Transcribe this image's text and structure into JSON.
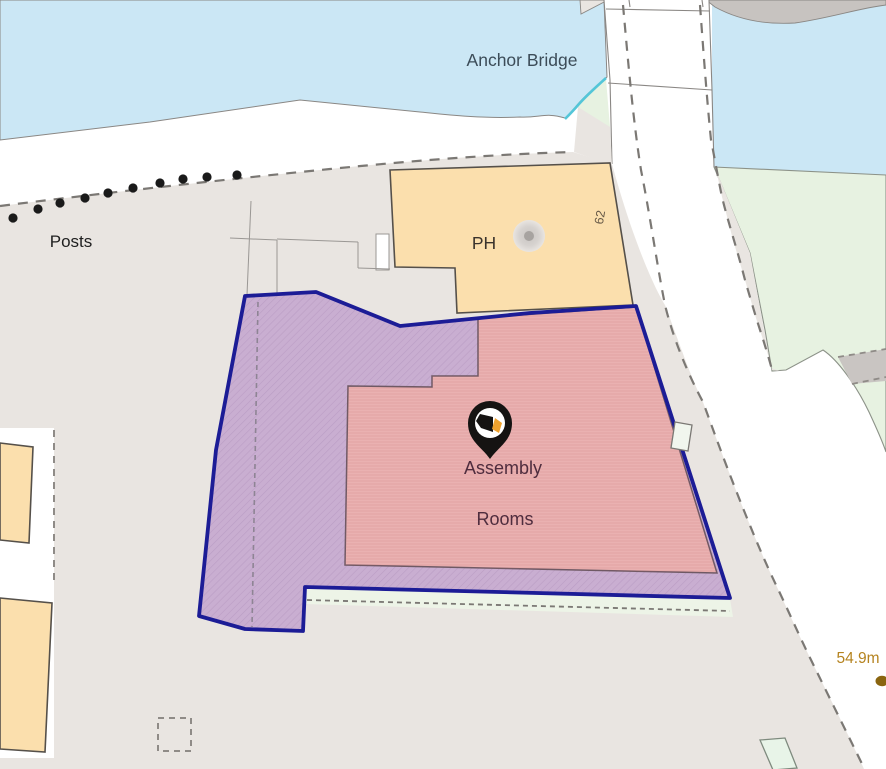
{
  "map": {
    "labels": {
      "bridge": "Anchor Bridge",
      "posts": "Posts",
      "public_house": "PH",
      "building_number": "62",
      "property_name_line1": "Assembly",
      "property_name_line2": "Rooms",
      "spot_height": "54.9m"
    },
    "colors": {
      "water": "#cbe7f5",
      "land": "#e9e5e1",
      "greenspace": "#e7f2e1",
      "greenspace_strip": "#edf4e7",
      "building_tan": "#fbdfad",
      "building_tan_outline": "#55504a",
      "building_pink": "#eab1b1",
      "building_pink_outline": "#6f5964",
      "curtilage_purple": "#c9aed1",
      "boundary_blue": "#1c1c96",
      "stream_cyan": "#54c6d8",
      "dark_gray": "#c7c3c0",
      "bridge_text": "#3c4c58",
      "posts_text": "#1f1f1f",
      "ph_text": "#3a332c",
      "property_text": "#4f2d3e",
      "spot_height_text": "#b5831f",
      "house_number_text": "#655846",
      "pin_black": "#151312",
      "pin_orange": "#f0a22e"
    }
  }
}
